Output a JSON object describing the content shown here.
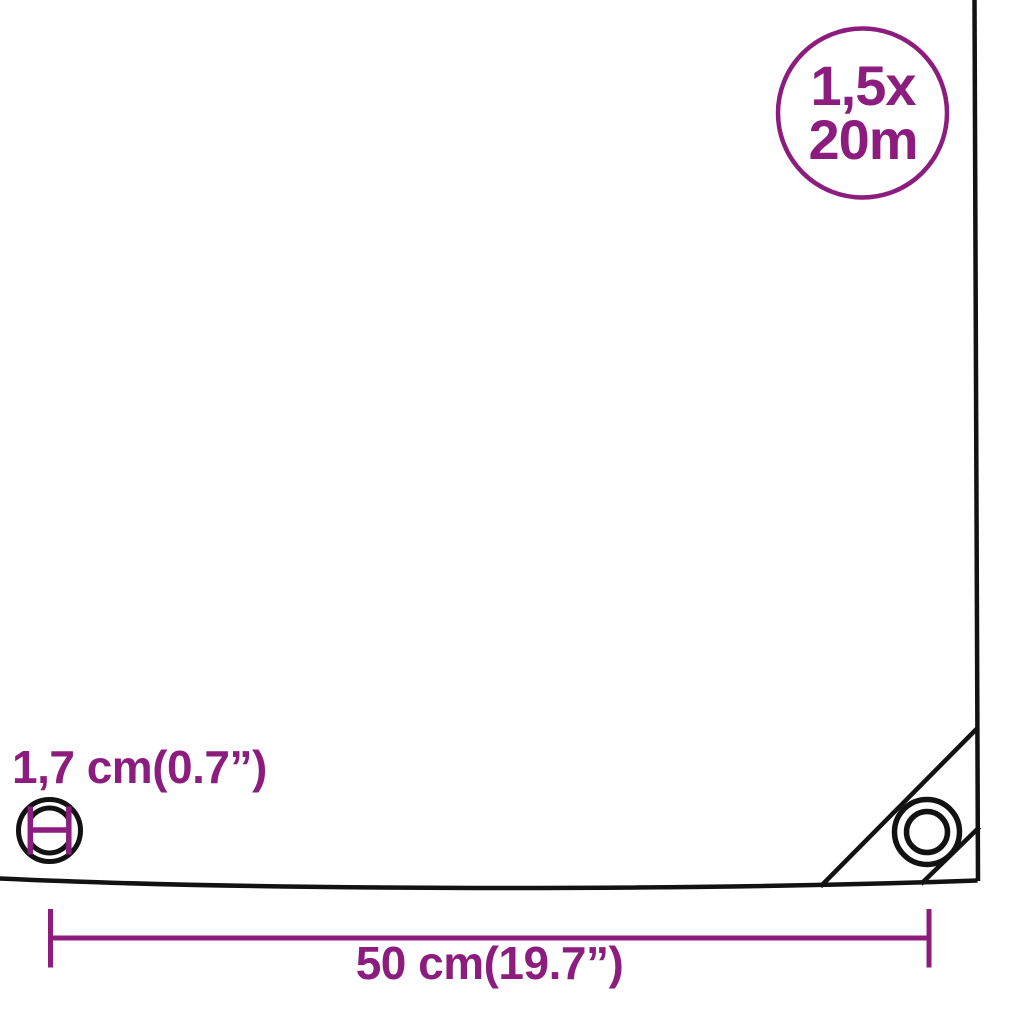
{
  "colors": {
    "accent": "#8C1D7E",
    "line": "#121212",
    "background": "#FFFFFF"
  },
  "size_badge": {
    "line1": "1,5x",
    "line2": "20m"
  },
  "eyelet": {
    "diameter_label": "1,7 cm(0.7”)"
  },
  "width_dimension": {
    "label": "50 cm(19.7”)"
  }
}
